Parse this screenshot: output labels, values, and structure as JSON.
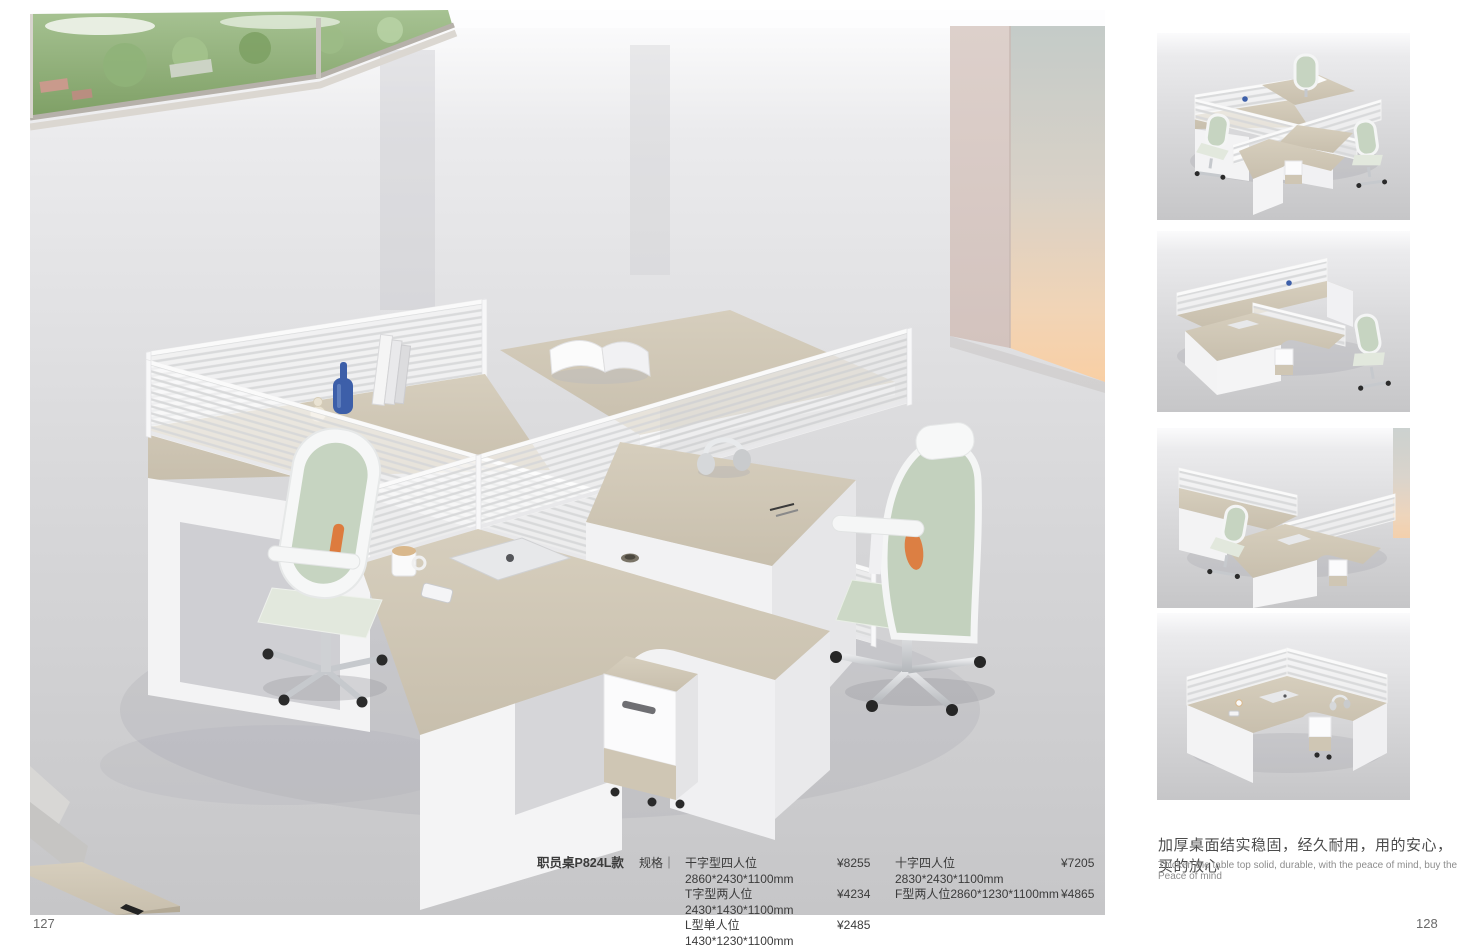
{
  "page": {
    "left_number": "127",
    "right_number": "128"
  },
  "product": {
    "model": "职员桌P824L款",
    "spec_label": "规格",
    "separator": "｜",
    "rows": [
      {
        "d1": "干字型四人位2860*2430*1100mm",
        "p1": "¥8255",
        "d2": "十字四人位2830*2430*1100mm",
        "p2": "¥7205"
      },
      {
        "d1": "T字型两人位2430*1430*1100mm",
        "p1": "¥4234",
        "d2": "F型两人位2860*1230*1100mm",
        "p2": "¥4865"
      },
      {
        "d1": "L型单人位1430*1230*1100mm",
        "p1": "¥2485",
        "d2": "",
        "p2": ""
      }
    ]
  },
  "caption": {
    "zh": "加厚桌面结实稳固，经久耐用，用的安心，买的放心",
    "en": "Thicken the table top solid, durable, with the peace of mind, buy the Peace of mind"
  },
  "colors": {
    "desk_wood": "#cfc7b6",
    "partition_white": "#f5f5f5",
    "chair_sage": "#c3d1bd",
    "chair_accent_orange": "#e0712e",
    "accent_wall_peach": "#f6cfa6",
    "bottle_blue": "#3d5fa9",
    "floor_gray": "#d6d6d8"
  }
}
